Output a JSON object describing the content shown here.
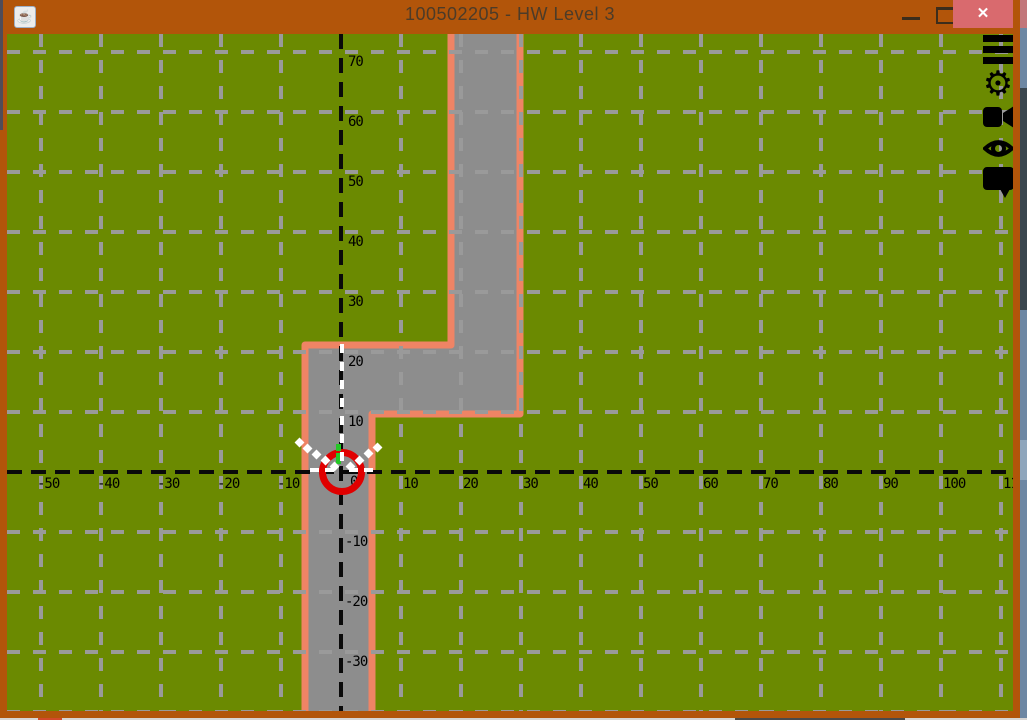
{
  "window": {
    "title": "100502205 - HW Level 3",
    "java_badge_glyph": "☕",
    "controls": {
      "minimize_label": "",
      "maximize_label": "",
      "close_label": "✕"
    }
  },
  "toolbar_icons": [
    {
      "name": "menu"
    },
    {
      "name": "settings-gear"
    },
    {
      "name": "video-camera"
    },
    {
      "name": "eye"
    },
    {
      "name": "speech-bubble"
    }
  ],
  "scene": {
    "colors": {
      "grass": "#6b8a01",
      "road_fill": "#8d8d8d",
      "road_border": "#ef8465",
      "grid": "#9a9a9a",
      "axis": "#0a0a0a",
      "robot": "#e00000",
      "ray": "#ffffff",
      "heading": "#25c825",
      "titlebar": "#b2550a",
      "close_button": "#d96a6e"
    },
    "grid": {
      "origin_px": [
        334,
        438
      ],
      "px_per_unit": 6,
      "spacing_units": 10,
      "content_w": 1006,
      "content_h": 677
    },
    "x_tick_labels": [
      -50,
      -40,
      -30,
      -20,
      -10,
      10,
      20,
      30,
      40,
      50,
      60,
      70,
      80,
      90,
      100,
      110
    ],
    "y_tick_labels": [
      70,
      60,
      50,
      40,
      30,
      20,
      10,
      -10,
      -20,
      -30
    ],
    "x_gridlines": [
      -50,
      -40,
      -30,
      -20,
      -10,
      10,
      20,
      30,
      40,
      50,
      60,
      70,
      80,
      90,
      100,
      110
    ],
    "y_gridlines": [
      70,
      60,
      50,
      40,
      30,
      20,
      10,
      -10,
      -20,
      -30,
      -40
    ],
    "origin_label": "0",
    "road_path": "M444,-10 L444,311 L298,311 L298,690 L365,690 L365,380 L513,380 L513,-10 Z",
    "robot": {
      "center_px": [
        335,
        438
      ],
      "outer_radius": 23,
      "ring_stroke": 7,
      "world_pos": "0,0"
    },
    "heading_marks": [
      [
        329,
        410,
        5,
        7
      ],
      [
        329,
        419,
        5,
        11
      ]
    ],
    "ray_diamonds": [
      [
        327,
        432
      ],
      [
        318,
        426
      ],
      [
        309,
        420
      ],
      [
        300,
        414
      ],
      [
        292,
        408
      ],
      [
        343,
        432
      ],
      [
        352,
        426
      ],
      [
        361,
        419
      ],
      [
        370,
        413
      ]
    ],
    "ray_v_dashes_x": 333,
    "ray_v_dashes_y": [
      310,
      328,
      346,
      364,
      382,
      400,
      418
    ],
    "ray_h_dashes_y": 434,
    "ray_h_dashes_x": [
      303,
      318,
      342,
      357
    ]
  }
}
